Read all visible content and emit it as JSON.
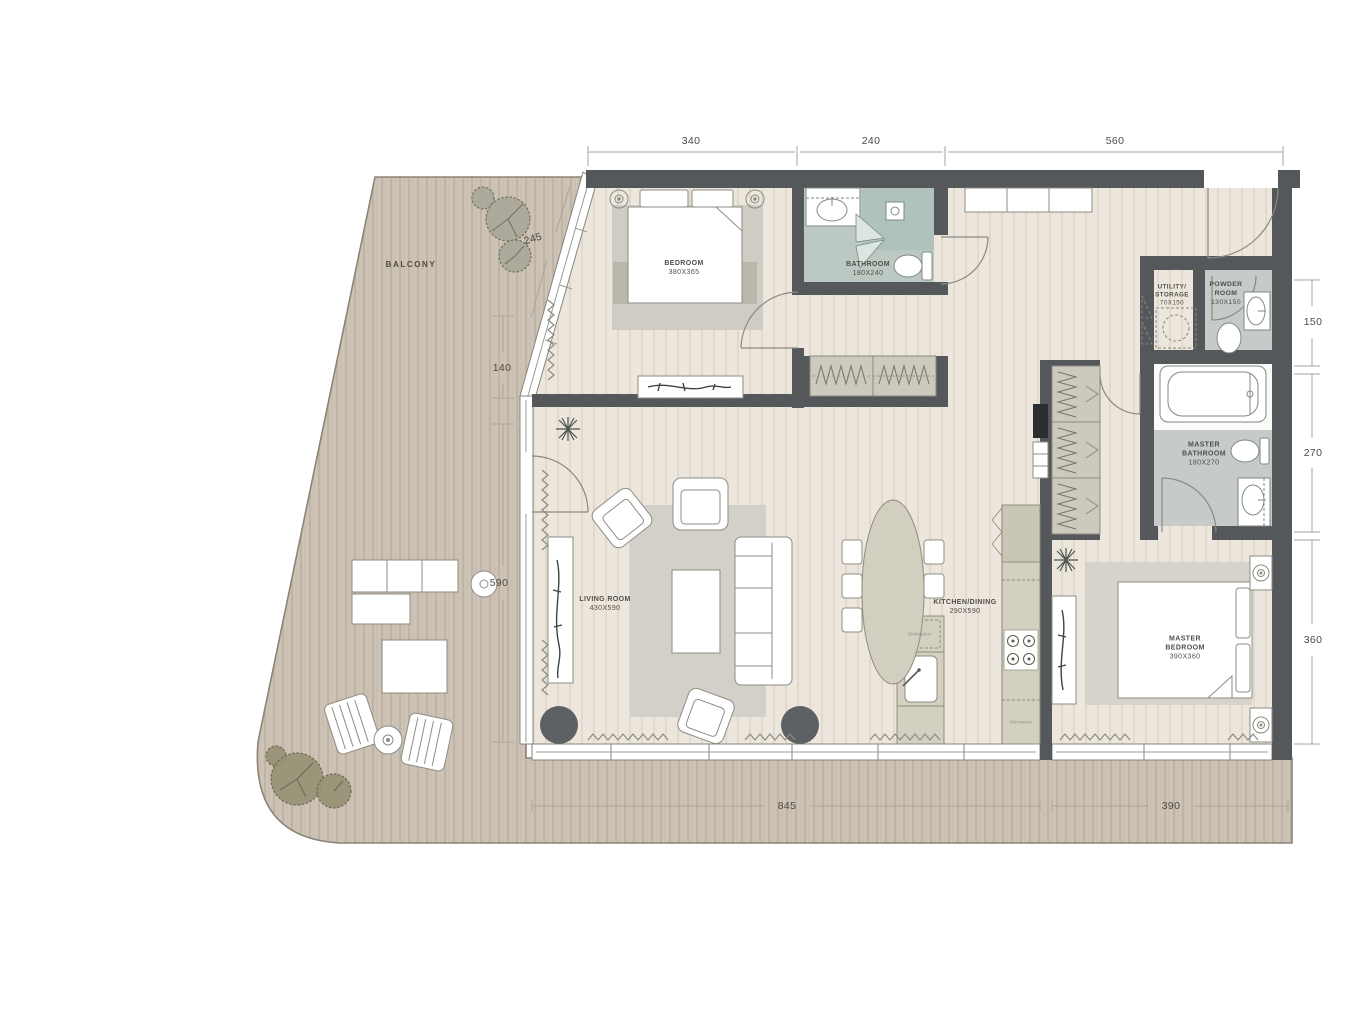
{
  "plan": {
    "balcony_label": "BALCONY",
    "rooms": {
      "bedroom": {
        "name": "BEDROOM",
        "size": "380X365"
      },
      "bathroom": {
        "name": "BATHROOM",
        "size": "180X240"
      },
      "utility": {
        "line1": "UTILITY/",
        "line2": "STORAGE",
        "size": "70X150"
      },
      "powder": {
        "line1": "POWDER",
        "line2": "ROOM",
        "size": "130X150"
      },
      "master_bathroom": {
        "line1": "MASTER",
        "line2": "BATHROOM",
        "size": "180X270"
      },
      "living_room": {
        "name": "LIVING ROOM",
        "size": "430X590"
      },
      "kitchen_dining": {
        "name": "KITCHEN/DINING",
        "size": "290X590"
      },
      "master_bedroom": {
        "line1": "MASTER",
        "line2": "BEDROOM",
        "size": "390X360"
      }
    },
    "appliances": {
      "dishwasher": "Dishwasher",
      "microwave": "Microwave"
    },
    "dimensions": {
      "top": [
        "340",
        "240",
        "560"
      ],
      "right": [
        "150",
        "270",
        "360"
      ],
      "bottom": [
        "845",
        "390"
      ],
      "balcony": [
        "245",
        "140",
        "590"
      ]
    },
    "colors": {
      "wall": "#54585a",
      "deck": "#cdc3b6",
      "floor": "#ece6dc",
      "bath_tile": "#bcc9c3",
      "wet_room": "#c6cac8",
      "accent_dark": "#5d6163"
    }
  }
}
